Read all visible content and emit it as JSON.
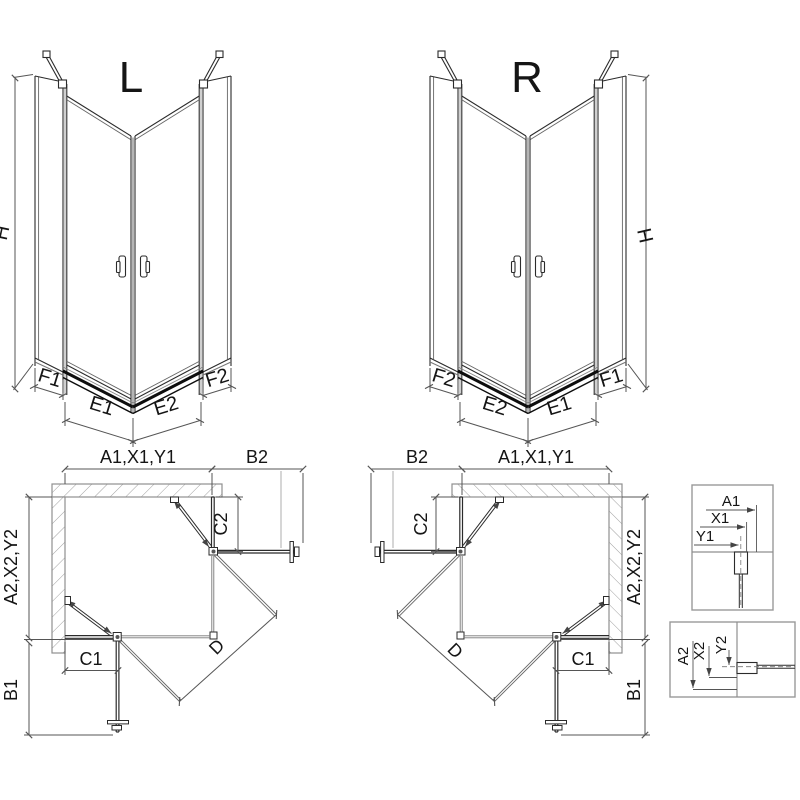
{
  "drawing": {
    "background": "#ffffff",
    "line_color": "#2b2b2b",
    "dim_color": "#555555",
    "wall_color": "#8f8f8f",
    "front_left": {
      "title": "L",
      "height_label": "H",
      "outer_left": "F1",
      "door_left": "E1",
      "door_right": "E2",
      "outer_right": "F2"
    },
    "front_right": {
      "title": "R",
      "height_label": "H",
      "outer_left": "F2",
      "door_left": "E2",
      "door_right": "E1",
      "outer_right": "F1"
    },
    "plan_left": {
      "top_width": "A1,X1,Y1",
      "door_top": "B2",
      "side_depth": "A2,X2,Y2",
      "fixed_right": "C2",
      "fixed_bottom": "C1",
      "door_side": "B1",
      "diagonal": "D"
    },
    "plan_right": {
      "top_width": "A1,X1,Y1",
      "door_top": "B2",
      "side_depth": "A2,X2,Y2",
      "fixed_left": "C2",
      "fixed_bottom": "C1",
      "door_side": "B1",
      "diagonal": "D"
    },
    "detail_top": {
      "dim1": "A1",
      "dim2": "X1",
      "dim3": "Y1"
    },
    "detail_bottom": {
      "dim1": "A2",
      "dim2": "X2",
      "dim3": "Y2"
    }
  }
}
